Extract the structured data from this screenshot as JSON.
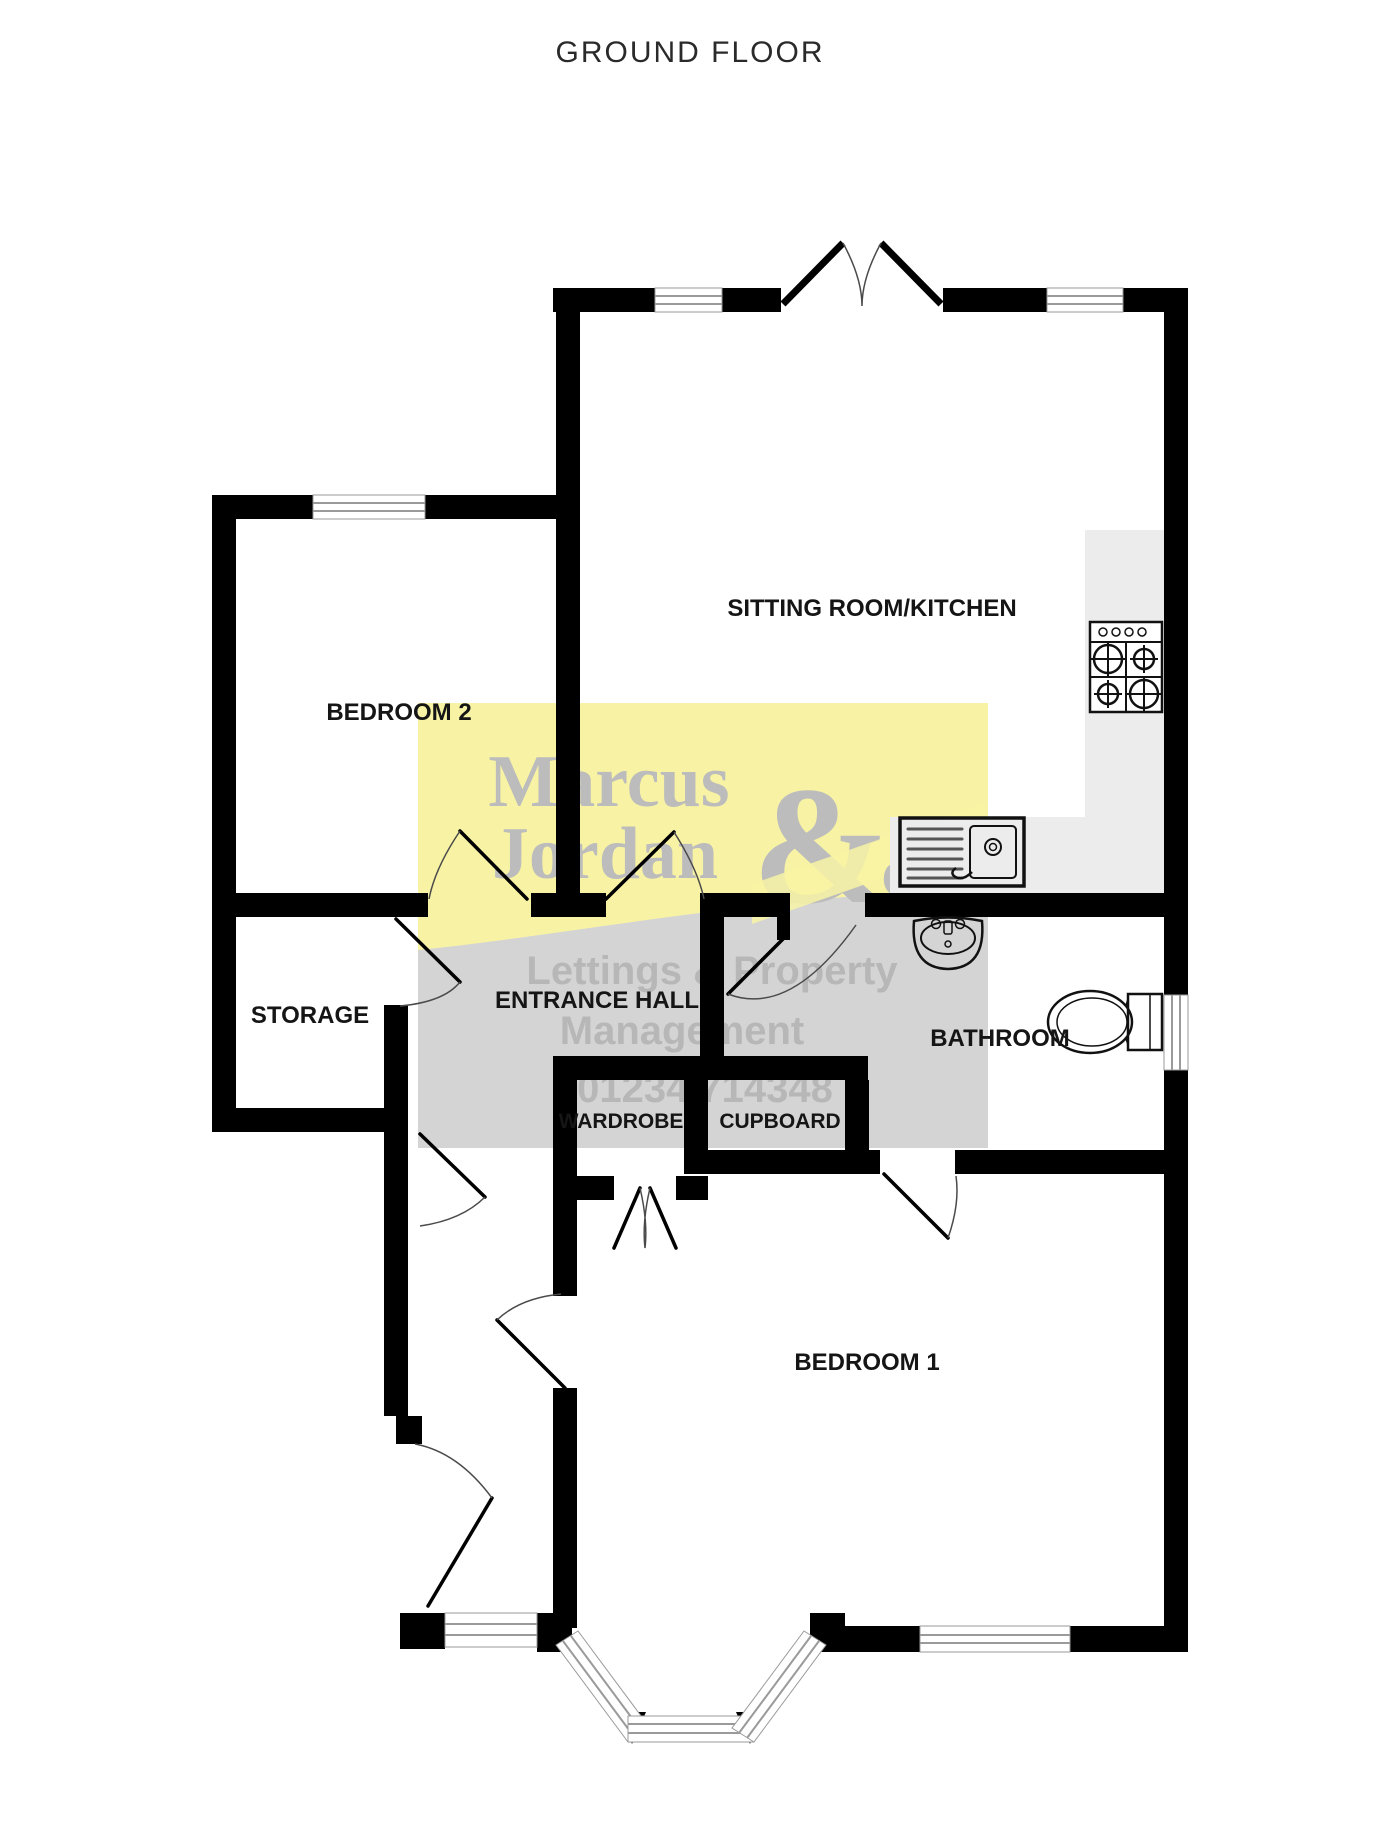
{
  "title": "GROUND FLOOR",
  "rooms": {
    "sitting": "SITTING ROOM/KITCHEN",
    "bed2": "BEDROOM 2",
    "hall": "ENTRANCE HALL",
    "storage": "STORAGE",
    "bath": "BATHROOM",
    "wardrobe": "WARDROBE",
    "cupboard": "CUPBOARD",
    "bed1": "BEDROOM 1"
  },
  "watermark": {
    "name1": "Marcus",
    "name2": "Jordan",
    "ampersand": "&",
    "co": "Co",
    "tagline1": "Lettings & Property",
    "tagline2": "Management",
    "phone": "01234 714348"
  },
  "colors": {
    "wall": "#000000",
    "watermark_yellow": "#f8f3a4",
    "watermark_gray": "#d4d4d4",
    "logo_text_gray": "#bcbcbc",
    "tag_text_gray": "#b7b7b7",
    "counter_gray": "#ececec"
  },
  "fixtures": {
    "hob": "4-burner hob",
    "sink": "kitchen sink with drainer",
    "basin": "wash basin",
    "toilet": "toilet"
  }
}
